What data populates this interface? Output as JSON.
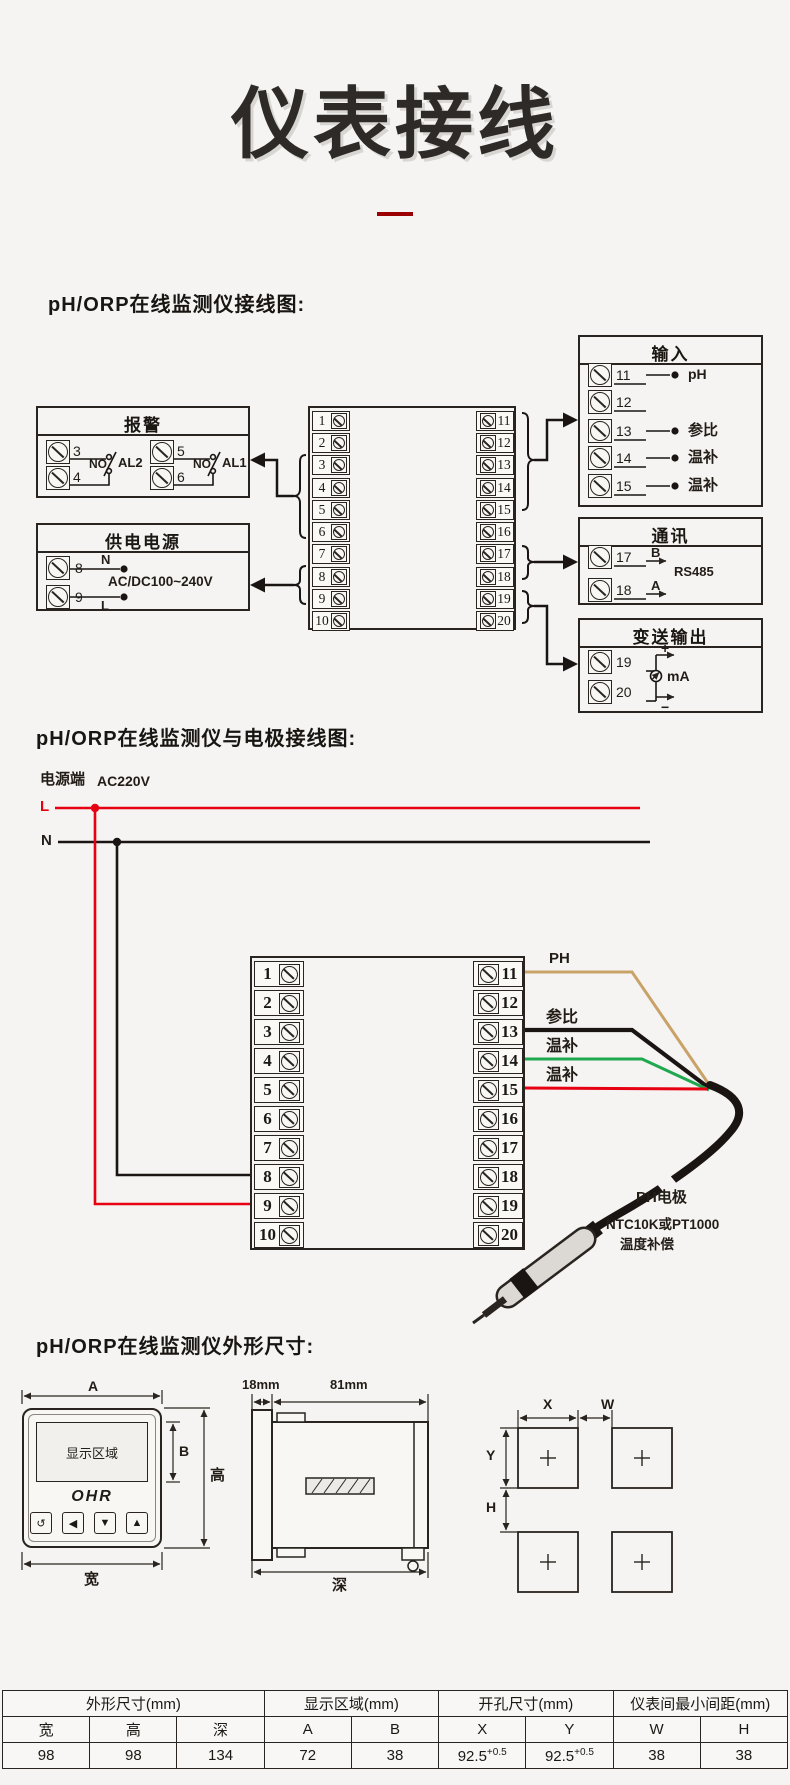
{
  "title": "仪表接线",
  "headings": {
    "h1": "pH/ORP在线监测仪接线图:",
    "h2": "pH/ORP在线监测仪与电极接线图:",
    "h3": "pH/ORP在线监测仪外形尺寸:"
  },
  "colors": {
    "accent_dark_red": "#9b0003",
    "line_black": "#29241f",
    "wire_ph_tan": "#c9a268",
    "wire_ref_black": "#1a1512",
    "wire_temp_green": "#1fa84f",
    "wire_live_red": "#e60012"
  },
  "d1": {
    "left": [
      "1",
      "2",
      "3",
      "4",
      "5",
      "6",
      "7",
      "8",
      "9",
      "10"
    ],
    "right": [
      "11",
      "12",
      "13",
      "14",
      "15",
      "16",
      "17",
      "18",
      "19",
      "20"
    ],
    "alarm": {
      "title": "报警",
      "n3": "3",
      "n4": "4",
      "n5": "5",
      "n6": "6",
      "no_a": "NO",
      "no_b": "NO",
      "al2": "AL2",
      "al1": "AL1"
    },
    "power": {
      "title": "供电电源",
      "n8": "8",
      "n9": "9",
      "n": "N",
      "l": "L",
      "range": "AC/DC100~240V"
    },
    "input": {
      "title": "输入",
      "n11": "11",
      "n12": "12",
      "n13": "13",
      "n14": "14",
      "n15": "15",
      "l11": "pH",
      "l13": "参比",
      "l14": "温补",
      "l15": "温补"
    },
    "comm": {
      "title": "通讯",
      "n17": "17",
      "n18": "18",
      "b": "B",
      "a": "A",
      "proto": "RS485"
    },
    "out": {
      "title": "变送输出",
      "n19": "19",
      "n20": "20",
      "plus": "+",
      "minus": "−",
      "unit": "mA"
    }
  },
  "d2": {
    "left": [
      "1",
      "2",
      "3",
      "4",
      "5",
      "6",
      "7",
      "8",
      "9",
      "10"
    ],
    "right": [
      "11",
      "12",
      "13",
      "14",
      "15",
      "16",
      "17",
      "18",
      "19",
      "20"
    ],
    "mains": {
      "label": "电源端",
      "voltage": "AC220V",
      "l": "L",
      "n": "N"
    },
    "wires": {
      "ph": "PH",
      "ref": "参比",
      "t1": "温补",
      "t2": "温补"
    },
    "electrode": {
      "name": "PH电极",
      "desc1": "NTC10K或PT1000",
      "desc2": "温度补偿"
    }
  },
  "dims": {
    "front": {
      "display": "显示区域",
      "brand": "OHR",
      "buttons": [
        "↺",
        "◀",
        "▼",
        "▲"
      ],
      "a": "A",
      "b": "B",
      "h": "高",
      "w": "宽"
    },
    "side": {
      "front_depth": "18mm",
      "body_depth": "81mm",
      "d": "深"
    },
    "cut": {
      "x": "X",
      "w": "W",
      "y": "Y",
      "h": "H"
    }
  },
  "table": {
    "groups": [
      "外形尺寸(mm)",
      "显示区域(mm)",
      "开孔尺寸(mm)",
      "仪表间最小间距(mm)"
    ],
    "cols": [
      "宽",
      "高",
      "深",
      "A",
      "B",
      "X",
      "Y",
      "W",
      "H"
    ],
    "values": [
      "98",
      "98",
      "134",
      "72",
      "38",
      "92.5",
      "92.5",
      "38",
      "38"
    ],
    "tol": "+0.5"
  }
}
